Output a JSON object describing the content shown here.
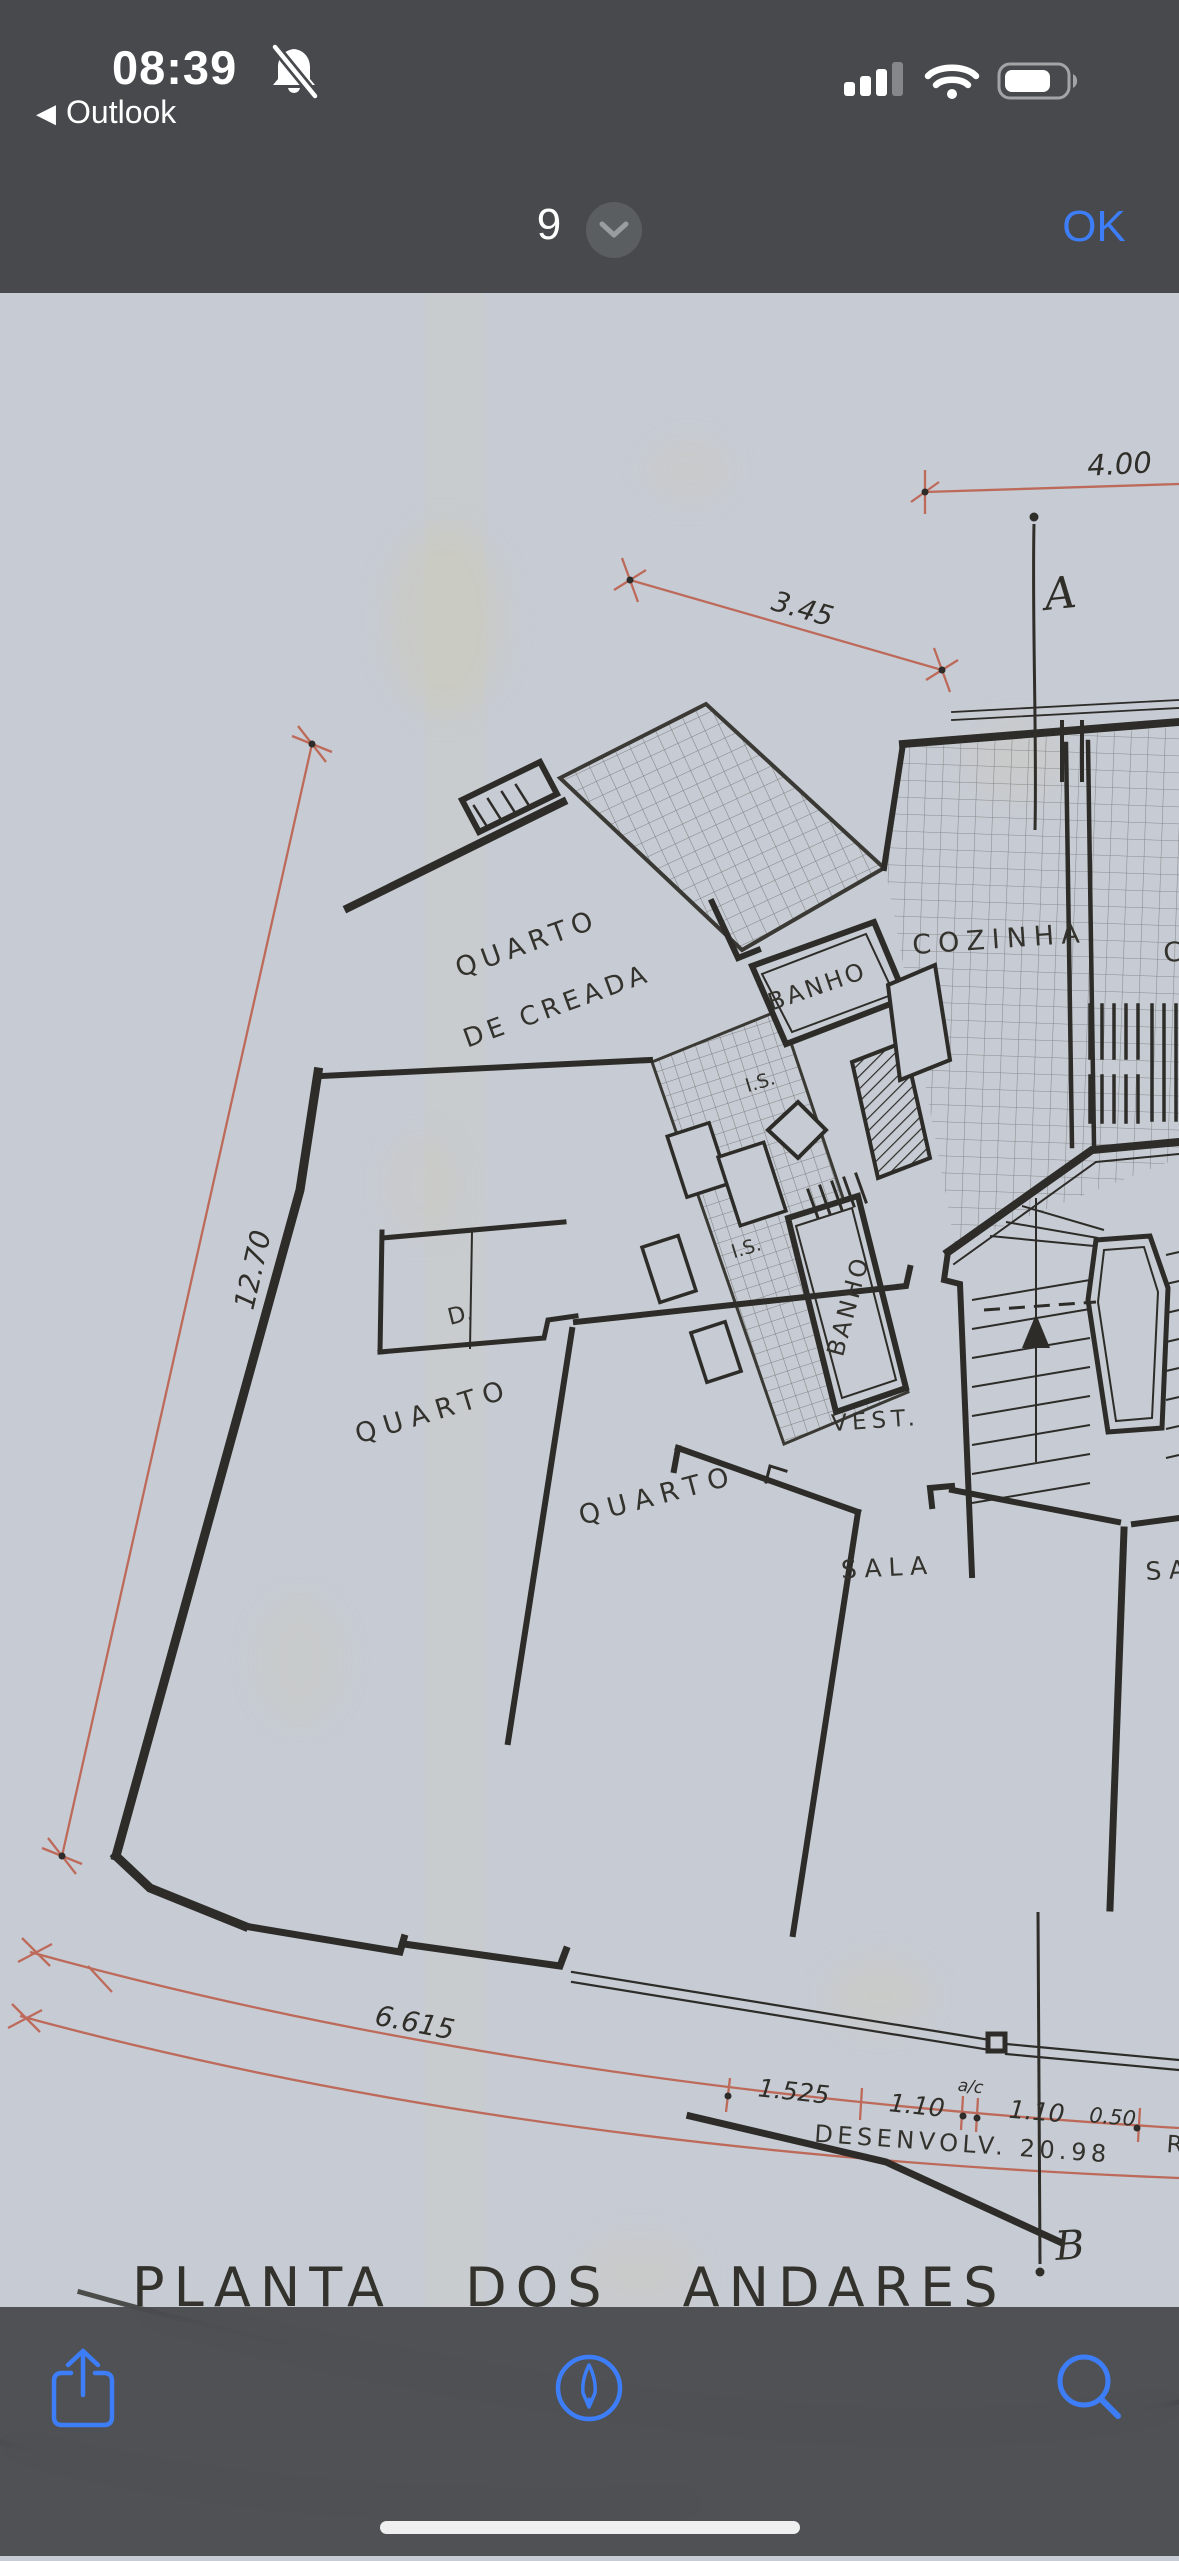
{
  "status_bar": {
    "time": "08:39",
    "back_arrow": "◀",
    "back_app": "Outlook"
  },
  "nav_bar": {
    "page_indicator": "9",
    "confirm_label": "OK"
  },
  "plan": {
    "title": "PLANTA  DOS  ANDARES",
    "rooms": {
      "maid_room_line1": "QUARTO",
      "maid_room_line2": "DE CREADA",
      "kitchen": "COZINHA",
      "kitchen_partial": "CO",
      "bath1": "BANHO",
      "bath2": "BANHO",
      "wc1": "I.S.",
      "wc2": "I.S.",
      "closet": "D.",
      "bedroom1": "QUARTO",
      "bedroom2": "QUARTO",
      "living": "SALA",
      "living_partial": "SA",
      "vestibule": "VEST."
    },
    "dimensions": {
      "top": "4.00",
      "upper_diag": "3.45",
      "left_diag": "12.70",
      "bottom_arc": "6.615",
      "seg1": "1.525",
      "seg2": "1.10",
      "seg_note": "a/c",
      "seg3": "1.10",
      "seg4": "0.50",
      "development": "DESENVOLV. 20.98",
      "partial_right": "R"
    },
    "sections": {
      "a": "A",
      "b": "B"
    }
  },
  "toolbar": {
    "icons": [
      "share",
      "markup",
      "search"
    ]
  },
  "colors": {
    "accent_blue": "#3d7ef8",
    "header_gray": "#47494c",
    "paper": "#c7ccd4",
    "ink": "#2d2c28",
    "dimension_red": "#bd6a5a"
  }
}
